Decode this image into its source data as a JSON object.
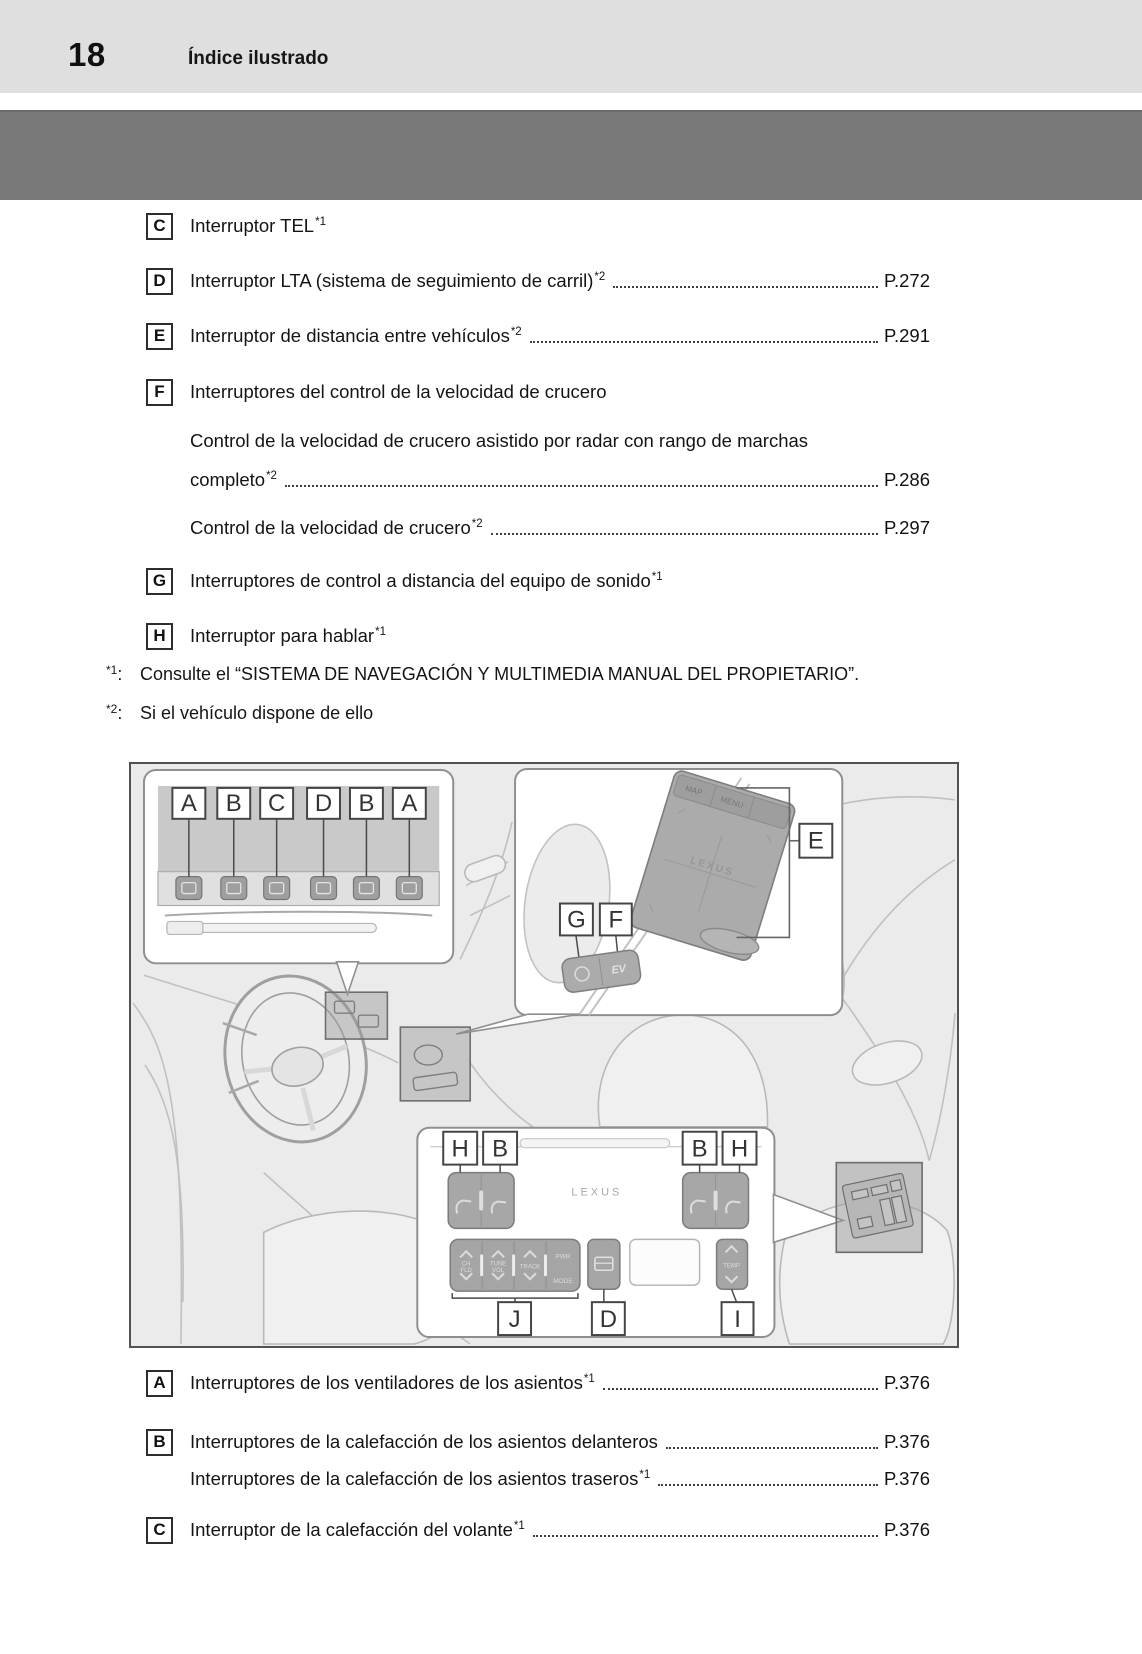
{
  "page": {
    "number": "18",
    "header_title": "Índice ilustrado"
  },
  "toc_upper": {
    "rows": [
      {
        "letter": "C",
        "text": "Interruptor TEL",
        "sup": "*1",
        "page": ""
      },
      {
        "letter": "D",
        "text": "Interruptor LTA (sistema de seguimiento de carril)",
        "sup": "*2",
        "page": "P.272"
      },
      {
        "letter": "E",
        "text": "Interruptor de distancia entre vehículos",
        "sup": "*2",
        "page": "P.291"
      },
      {
        "letter": "F",
        "text": "Interruptores del control de la velocidad de crucero",
        "sup": "",
        "page": ""
      },
      {
        "letter": "",
        "text": "Control de la velocidad de crucero asistido por radar con rango de marchas",
        "sup": "",
        "page": ""
      },
      {
        "letter": "",
        "text": "completo",
        "sup": "*2",
        "page": "P.286"
      },
      {
        "letter": "",
        "text": "Control de la velocidad de crucero",
        "sup": "*2",
        "page": "P.297"
      },
      {
        "letter": "G",
        "text": "Interruptores de control a distancia del equipo de sonido",
        "sup": "*1",
        "page": ""
      },
      {
        "letter": "H",
        "text": "Interruptor para hablar",
        "sup": "*1",
        "page": ""
      }
    ]
  },
  "footnotes": [
    {
      "marker": "*1",
      "colon": ":",
      "text": "Consulte el “SISTEMA DE NAVEGACIÓN Y MULTIMEDIA MANUAL DEL PROPIETARIO”."
    },
    {
      "marker": "*2",
      "colon": ":",
      "text": "Si el vehículo dispone de ello"
    }
  ],
  "toc_lower": {
    "rows": [
      {
        "letter": "A",
        "text": "Interruptores de los ventiladores de los asientos",
        "sup": "*1",
        "page": "P.376"
      },
      {
        "letter": "B",
        "text": "Interruptores de la calefacción de los asientos delanteros",
        "sup": "",
        "page": "P.376"
      },
      {
        "letter": "",
        "text": "Interruptores de la calefacción de los asientos traseros",
        "sup": "*1",
        "page": "P.376"
      },
      {
        "letter": "C",
        "text": "Interruptor de la calefacción del volante",
        "sup": "*1",
        "page": "P.376"
      }
    ]
  },
  "illustration": {
    "inset1_labels": [
      "A",
      "B",
      "C",
      "D",
      "B",
      "A"
    ],
    "inset2_label_e": "E",
    "inset2_label_g": "G",
    "inset2_label_f": "F",
    "touchpad_logo": "LEXUS",
    "touchpad_btn_map": "MAP",
    "touchpad_btn_menu": "MENU",
    "ev_button": "EV",
    "panel_logo": "LEXUS",
    "inset3_top_labels": [
      "H",
      "B",
      "B",
      "H"
    ],
    "inset3_bottom_labels": [
      "J",
      "D",
      "I"
    ],
    "audio_ch": "CH",
    "audio_fld": "FLD",
    "audio_tune": "TUNE",
    "audio_track": "TRACK",
    "audio_vol": "VOL",
    "audio_pwr": "PWR",
    "audio_mode": "MODE",
    "temp_label": "TEMP"
  },
  "colors": {
    "header_band": "#dfdfdf",
    "chapter_band": "#787878",
    "illustration_bg": "#ebebeb"
  }
}
